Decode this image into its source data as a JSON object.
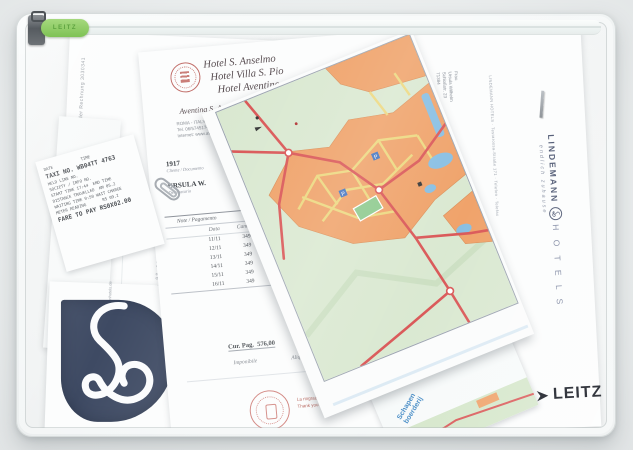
{
  "product": {
    "brand_logo": "LEITZ",
    "slider_label": "LEITZ"
  },
  "left_invoice": {
    "side_text": "Seite 1 der Rechnung 3030341",
    "digits_column": "05 98 05 25 03 05 86"
  },
  "hotel_invoice": {
    "name_line_1": "Hotel S. Anselmo",
    "name_line_2": "Hotel Villa S. Pio",
    "name_line_3": "Hotel Aventino",
    "street_line": "Aventina S. Anselmo 2",
    "city_line": "ROMA - ITALY - 00153",
    "phone_line": "Tel. 06/5745174 - 5743547",
    "web_line": "Internet: www.aventinohotels.com",
    "doc_no": "1917",
    "doc_label": "Cliente / Documento",
    "guest_name": "URSULA W.",
    "guest_label": "Destinatario",
    "section_title": "Note / Pagamento",
    "col_date": "Data",
    "col_room": "Camera",
    "rows": [
      {
        "date": "11/11",
        "room": "349",
        "desc": "MEZZA PENSIONE"
      },
      {
        "date": "12/11",
        "room": "349",
        "desc": "BED AND BREAKFAST"
      },
      {
        "date": "13/11",
        "room": "349",
        "desc": "BED AND BREAKFAST"
      },
      {
        "date": "14/11",
        "room": "349",
        "desc": "BED AND BREAKFAST"
      },
      {
        "date": "15/11",
        "room": "349",
        "desc": "BED AND BREAKFAST"
      },
      {
        "date": "16/11",
        "room": "349",
        "desc": "BED AND BREAKFAST"
      }
    ],
    "cur_pag": "Cur. Pag.  576,00",
    "tax_label_1": "Imponibile",
    "tax_label_2": "Aliquota",
    "tax_label_3": "I.V.A.",
    "total_label_1": "Totale",
    "total_label_2": "Cassa",
    "total_label_3": "Totale Netto",
    "signature": "Carola Pad.",
    "footer_line_1": "La ringraziamo di aver soggiornato presso di noi",
    "footer_line_2": "Thank you for staying with us"
  },
  "taxi_receipt": {
    "header": "DATE            TIME",
    "taxi_no": "TAXI NO. WB04TT 4763",
    "line_1": "HELD LINE NO.",
    "line_2": "SOCIETY / INFO NO.",
    "line_3": "START TIME 17:44  END TIME",
    "line_4": "DISTANCE TRAVELLED  KM 05.2",
    "line_5": "WAITING TIME 0:50 WAIT CHARGE",
    "line_6": "METER READING       RS 09.2",
    "fare": "FARE TO PAY RS0X02.00"
  },
  "letter": {
    "sender_microtext": "LINDEMANN HOTELS · Testarossa-Straße 171 · Telefon · Telefax",
    "address_line_1": "Frau",
    "address_line_2": "Ursula Wilhelm",
    "address_line_3": "Schloßstr. 23",
    "address_line_4": "71384",
    "wordmark_top": "LINDEMANN",
    "wordmark_bottom": "H O T E L S",
    "tagline": "endlich zuhause"
  },
  "brochure": {
    "url_text": "www.lindemannhotels.de"
  },
  "map": {
    "legend_word_1": "Schapen",
    "legend_word_2": "boerderij",
    "parking_label": "P"
  },
  "colors": {
    "slider_green": "#8bc95e",
    "map_green": "#d9e8d0",
    "map_orange": "#efa066",
    "map_road_red": "#d95454",
    "map_water_blue": "#85bde2",
    "navy_logo": "#3e4a63",
    "leitz_navy": "#23272f",
    "stamp_red": "#c0392b"
  }
}
